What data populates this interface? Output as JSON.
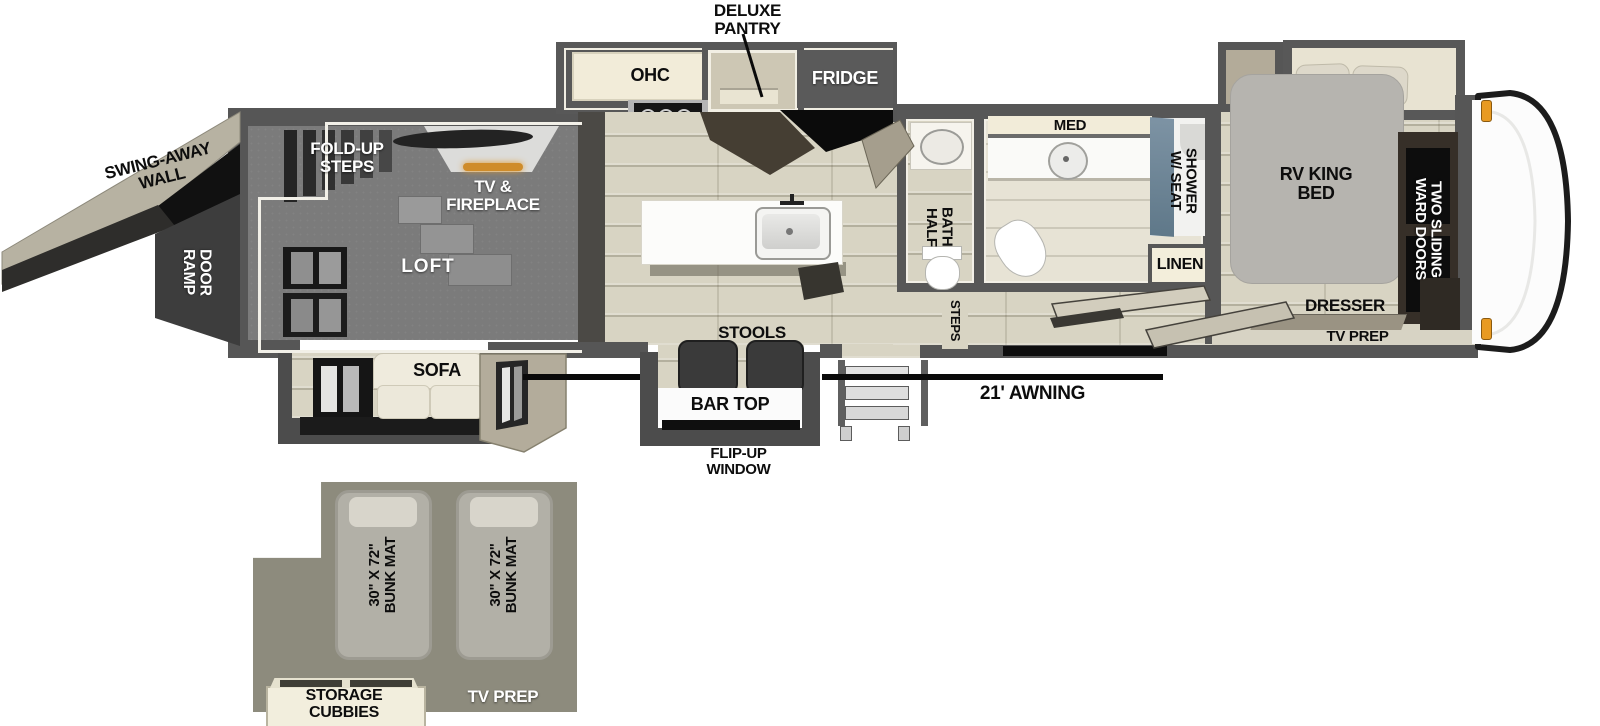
{
  "diagram_type": "rv-toy-hauler-floorplan",
  "labels": {
    "deluxe_pantry": "DELUXE\nPANTRY",
    "ohc": "OHC",
    "fridge": "FRIDGE",
    "swing_away_wall": "SWING-AWAY\nWALL",
    "ramp_door": "RAMP\nDOOR",
    "fold_up_steps": "FOLD-UP\nSTEPS",
    "tv_fireplace": "TV &\nFIREPLACE",
    "loft": "LOFT",
    "sofa": "SOFA",
    "stools": "STOOLS",
    "bar_top": "BAR TOP",
    "flip_up_window": "FLIP-UP\nWINDOW",
    "awning": "21' AWNING",
    "steps_entry": "STEPS",
    "half_bath": "HALF\nBATH",
    "med": "MED",
    "shower_w_seat": "SHOWER\nW/ SEAT",
    "linen": "LINEN",
    "rv_king_bed": "RV KING\nBED",
    "two_sliding_ward_doors": "TWO SLIDING\nWARD DOORS",
    "dresser": "DRESSER",
    "tv_prep_bedroom": "TV PREP",
    "bunk_mat_1": "30\" X 72\"\nBUNK MAT",
    "bunk_mat_2": "30\" X 72\"\nBUNK MAT",
    "storage_cubbies": "STORAGE\nCUBBIES",
    "tv_prep_bunk": "TV PREP"
  },
  "colors": {
    "wall_gray": "#565656",
    "floor_beige": "#d8d4c3",
    "carpet_gray": "#7b7b7b",
    "cabinet_cream": "#f2ecd9",
    "fridge_gray": "#5a5a5a",
    "bed_gray": "#b6b4af",
    "ward_cabinet_dark": "#362f28",
    "shower_glass_blue": "#6d8292",
    "bunk_inset_olive": "#8d8b7d",
    "marker_light_orange": "#e89a22",
    "awning_line_black": "#0a0a0a",
    "fireplace_glow": "#cf8c2a"
  }
}
